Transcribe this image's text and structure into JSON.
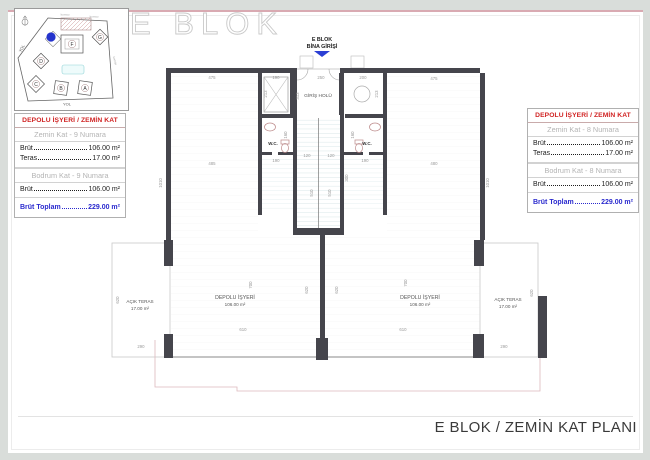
{
  "window": {
    "watermark": "E BLOK"
  },
  "title_block": {
    "text": "E BLOK / ZEMİN KAT PLANI"
  },
  "site": {
    "blocks": {
      "a": "A",
      "b": "B",
      "c": "C",
      "d": "D",
      "f": "F",
      "g": "G"
    },
    "road_left": "YOL",
    "road_bottom": "YOL",
    "neighbor1": "komşu",
    "neighbor2": "komşu",
    "neighbor3": "komşu",
    "highlight_color": "#2433cc"
  },
  "panel_left": {
    "header": "DEPOLU İŞYERİ / ZEMİN KAT",
    "floor1": "Zemin Kat - 9 Numara",
    "r1_label": "Brüt",
    "r1_value": "106.00 m²",
    "r2_label": "Teras",
    "r2_value": "17.00 m²",
    "floor2": "Bodrum Kat - 9 Numara",
    "r3_label": "Brüt",
    "r3_value": "106.00 m²",
    "total_label": "Brüt Toplam",
    "total_value": "229.00 m²"
  },
  "panel_right": {
    "header": "DEPOLU İŞYERİ / ZEMİN KAT",
    "floor1": "Zemin Kat - 8 Numara",
    "r1_label": "Brüt",
    "r1_value": "106.00 m²",
    "r2_label": "Teras",
    "r2_value": "17.00 m²",
    "floor2": "Bodrum Kat - 8 Numara",
    "r3_label": "Brüt",
    "r3_value": "106.00 m²",
    "total_label": "Brüt Toplam",
    "total_value": "229.00 m²"
  },
  "plan": {
    "entry_line1": "E BLOK",
    "entry_line2": "BİNA GİRİŞİ",
    "hall_label": "GİRİŞ HOLÜ",
    "wc_left": "W.C.",
    "wc_right": "W.C.",
    "shop_left_name": "DEPOLU İŞYERİ",
    "shop_left_area": "106.00 m²",
    "shop_right_name": "DEPOLU İŞYERİ",
    "shop_right_area": "106.00 m²",
    "terrace_left_name": "AÇIK TERAS",
    "terrace_left_area": "17.00 m²",
    "terrace_right_name": "AÇIK TERAS",
    "terrace_right_area": "17.00 m²",
    "dims": {
      "d475l": "475",
      "d190": "190",
      "d250": "250",
      "d200": "200",
      "d475r": "475",
      "d213l": "213",
      "d313": "313",
      "d213r": "213",
      "d485": "485",
      "d480": "480",
      "d120a": "120",
      "d120b": "120",
      "d300": "300",
      "d190wl": "190",
      "d160wl": "160",
      "d190wr": "190",
      "d160wr": "160",
      "d1010l": "1010",
      "d1010r": "1010",
      "d510l": "510",
      "d510r": "510",
      "d620dl": "620",
      "d620dr": "620",
      "d700l": "700",
      "d700r": "700",
      "d610l": "610",
      "d610r": "610",
      "d620tl": "620",
      "d620tr": "620",
      "d290tl": "290",
      "d290tr": "290"
    }
  },
  "colors": {
    "header_red": "#d02222",
    "total_blue": "#2a2ace",
    "wall": "#45454c",
    "entry_arrow": "#2b3fd4",
    "page_border_pink": "#d9aab2"
  }
}
